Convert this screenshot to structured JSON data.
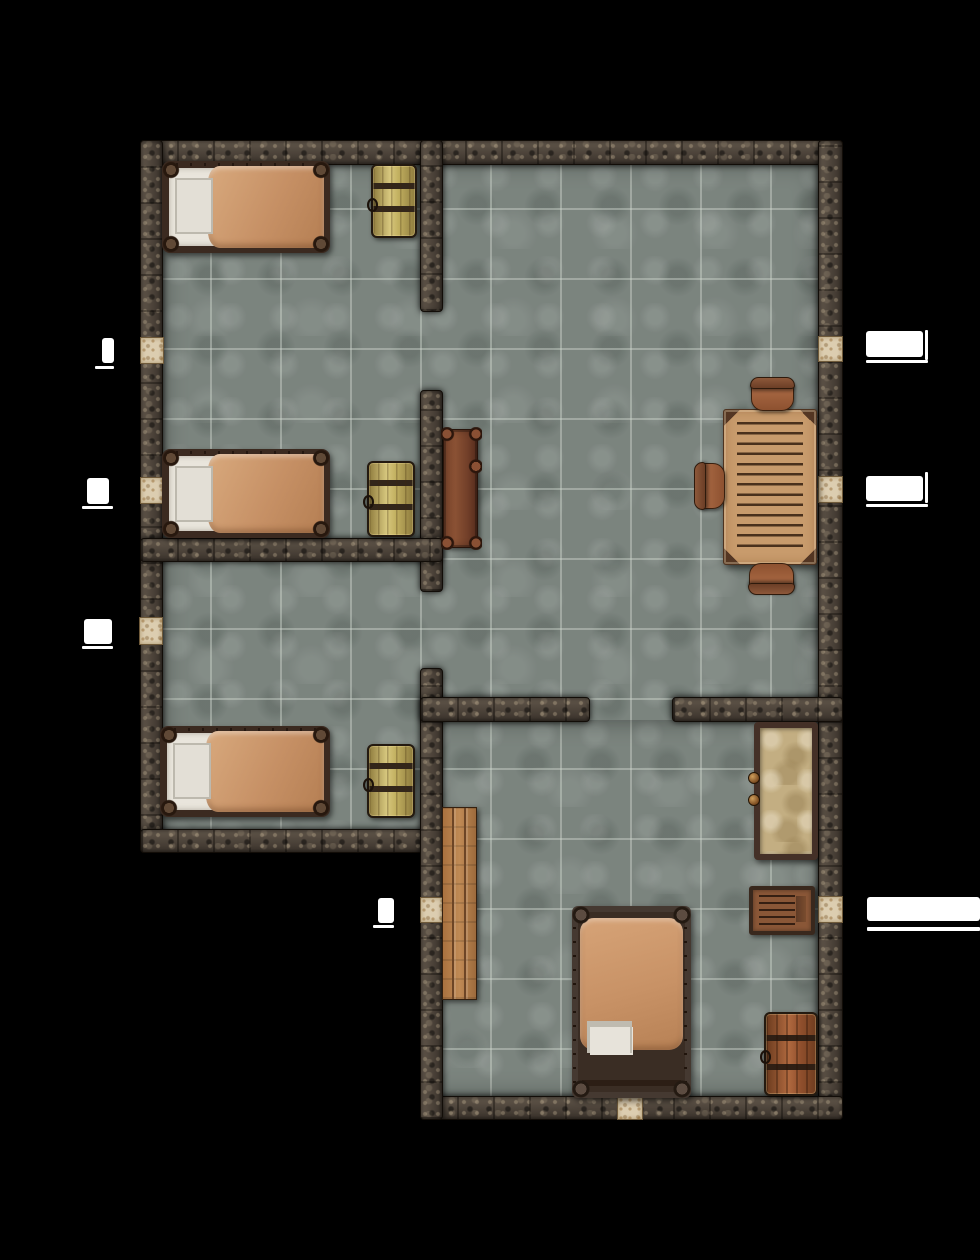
{
  "map": {
    "width": 980,
    "height": 1260,
    "grid_size_px": 70,
    "background_color": "#000000",
    "palette": {
      "floor": "#7b847e",
      "grout": "#ced6cd",
      "wall": "#4a4037",
      "door_tile": "#dccdb0",
      "door_marker": "#ffffff",
      "bed_frame": "#3b2a20",
      "bed_blanket": "#c69065",
      "bed_sheet": "#e9e5dc",
      "barrel_gold": "#c3b161",
      "barrel_red": "#8f4f2c",
      "table_wood": "#c89b6c",
      "chair_wood": "#a4683f",
      "bench_dark": "#7b452c",
      "bench_light": "#b07a4a",
      "cabinet_body": "#c3ae82",
      "dresser_body": "#8a5737"
    },
    "floors": [
      {
        "name": "floor-west-wing",
        "x": 162,
        "y": 162,
        "w": 656,
        "h": 690
      },
      {
        "name": "floor-south-wing",
        "x": 420,
        "y": 720,
        "w": 398,
        "h": 378
      }
    ],
    "walls": [
      {
        "name": "wall-north",
        "type": "wall-h",
        "x": 140,
        "y": 140,
        "w": 703,
        "h": 25
      },
      {
        "name": "wall-west",
        "type": "wall-v",
        "x": 140,
        "y": 140,
        "w": 23,
        "h": 713
      },
      {
        "name": "wall-east",
        "type": "wall-v",
        "x": 818,
        "y": 140,
        "w": 25,
        "h": 980
      },
      {
        "name": "wall-south",
        "type": "wall-h",
        "x": 420,
        "y": 1096,
        "w": 423,
        "h": 24
      },
      {
        "name": "wall-west-wing-south",
        "type": "wall-h",
        "x": 140,
        "y": 829,
        "w": 303,
        "h": 24
      },
      {
        "name": "wall-south-wing-west",
        "type": "wall-v",
        "x": 420,
        "y": 668,
        "w": 23,
        "h": 452
      },
      {
        "name": "wall-stub-north",
        "type": "wall-v",
        "x": 420,
        "y": 140,
        "w": 23,
        "h": 172
      },
      {
        "name": "wall-stub-mid",
        "type": "wall-v",
        "x": 420,
        "y": 390,
        "w": 23,
        "h": 202
      },
      {
        "name": "wall-bedroom-divider",
        "type": "wall-h",
        "x": 140,
        "y": 538,
        "w": 303,
        "h": 24
      },
      {
        "name": "wall-hall-south-west",
        "type": "wall-h",
        "x": 420,
        "y": 697,
        "w": 170,
        "h": 25
      },
      {
        "name": "wall-hall-south-east",
        "type": "wall-h",
        "x": 672,
        "y": 697,
        "w": 171,
        "h": 25
      }
    ],
    "doors": [
      {
        "name": "door-west-1",
        "x": 140,
        "y": 337,
        "w": 24,
        "h": 27
      },
      {
        "name": "door-west-2",
        "x": 140,
        "y": 477,
        "w": 24,
        "h": 27
      },
      {
        "name": "door-west-3",
        "x": 139,
        "y": 617,
        "w": 24,
        "h": 28
      },
      {
        "name": "door-east-1",
        "x": 818,
        "y": 336,
        "w": 25,
        "h": 26
      },
      {
        "name": "door-east-2",
        "x": 818,
        "y": 476,
        "w": 25,
        "h": 27
      },
      {
        "name": "door-south-wing-west",
        "x": 420,
        "y": 897,
        "w": 23,
        "h": 26
      },
      {
        "name": "door-south-wing-east",
        "x": 818,
        "y": 896,
        "w": 25,
        "h": 27
      },
      {
        "name": "door-south",
        "x": 617,
        "y": 1096,
        "w": 26,
        "h": 24
      }
    ],
    "door_markers": [
      {
        "name": "marker-west-1",
        "type": "marker",
        "x": 102,
        "y": 338,
        "w": 12,
        "h": 25
      },
      {
        "name": "marker-west-1-line",
        "type": "marker-line",
        "x": 95,
        "y": 366,
        "w": 19,
        "h": 3
      },
      {
        "name": "marker-west-2",
        "type": "marker",
        "x": 87,
        "y": 478,
        "w": 22,
        "h": 26
      },
      {
        "name": "marker-west-2-line",
        "type": "marker-line",
        "x": 82,
        "y": 506,
        "w": 31,
        "h": 3
      },
      {
        "name": "marker-west-3",
        "type": "marker",
        "x": 84,
        "y": 619,
        "w": 28,
        "h": 25
      },
      {
        "name": "marker-west-3-line",
        "type": "marker-line",
        "x": 82,
        "y": 646,
        "w": 31,
        "h": 3
      },
      {
        "name": "marker-east-1",
        "type": "marker",
        "x": 866,
        "y": 331,
        "w": 57,
        "h": 26
      },
      {
        "name": "marker-east-1-line",
        "type": "marker-line",
        "x": 866,
        "y": 360,
        "w": 62,
        "h": 3
      },
      {
        "name": "marker-east-1-jamb",
        "type": "marker-line",
        "x": 925,
        "y": 330,
        "w": 3,
        "h": 30
      },
      {
        "name": "marker-east-2",
        "type": "marker",
        "x": 866,
        "y": 476,
        "w": 57,
        "h": 25
      },
      {
        "name": "marker-east-2-line",
        "type": "marker-line",
        "x": 866,
        "y": 504,
        "w": 62,
        "h": 3
      },
      {
        "name": "marker-east-2-jamb",
        "type": "marker-line",
        "x": 925,
        "y": 472,
        "w": 3,
        "h": 31
      },
      {
        "name": "marker-south-east",
        "type": "marker",
        "x": 867,
        "y": 897,
        "w": 113,
        "h": 24
      },
      {
        "name": "marker-south-east-line",
        "type": "marker-line",
        "x": 867,
        "y": 927,
        "w": 113,
        "h": 4
      },
      {
        "name": "marker-south-west",
        "type": "marker",
        "x": 378,
        "y": 898,
        "w": 16,
        "h": 25
      },
      {
        "name": "marker-south-west-line",
        "type": "marker-line",
        "x": 373,
        "y": 925,
        "w": 21,
        "h": 3
      }
    ],
    "furniture": [
      {
        "name": "single-bed-1",
        "type": "bed-single",
        "x": 162,
        "y": 161,
        "w": 168,
        "h": 92
      },
      {
        "name": "single-bed-2",
        "type": "bed-single",
        "x": 162,
        "y": 449,
        "w": 168,
        "h": 89
      },
      {
        "name": "single-bed-3",
        "type": "bed-single",
        "x": 160,
        "y": 726,
        "w": 170,
        "h": 91
      },
      {
        "name": "barrel-1",
        "type": "barrel-gold",
        "x": 371,
        "y": 164,
        "w": 46,
        "h": 74
      },
      {
        "name": "barrel-2",
        "type": "barrel-gold",
        "x": 367,
        "y": 461,
        "w": 48,
        "h": 76
      },
      {
        "name": "barrel-3",
        "type": "barrel-gold",
        "x": 367,
        "y": 744,
        "w": 48,
        "h": 74
      },
      {
        "name": "side-table",
        "type": "bench-dark",
        "x": 443,
        "y": 429,
        "w": 35,
        "h": 119
      },
      {
        "name": "dining-table",
        "type": "table",
        "x": 723,
        "y": 409,
        "w": 94,
        "h": 156
      },
      {
        "name": "chair-north",
        "type": "chair chair-n",
        "x": 751,
        "y": 380,
        "w": 43,
        "h": 31
      },
      {
        "name": "chair-west",
        "type": "chair chair-w",
        "x": 697,
        "y": 463,
        "w": 28,
        "h": 46
      },
      {
        "name": "chair-south",
        "type": "chair chair-s",
        "x": 749,
        "y": 563,
        "w": 45,
        "h": 29
      },
      {
        "name": "cabinet",
        "type": "cabinet",
        "x": 754,
        "y": 722,
        "w": 64,
        "h": 138
      },
      {
        "name": "dresser",
        "type": "dresser",
        "x": 749,
        "y": 886,
        "w": 66,
        "h": 49
      },
      {
        "name": "barrel-4",
        "type": "barrel-red",
        "x": 764,
        "y": 1012,
        "w": 54,
        "h": 84
      },
      {
        "name": "bench",
        "type": "bench-light",
        "x": 442,
        "y": 807,
        "w": 35,
        "h": 193
      },
      {
        "name": "double-bed",
        "type": "bed-double",
        "x": 572,
        "y": 906,
        "w": 119,
        "h": 192
      }
    ]
  }
}
